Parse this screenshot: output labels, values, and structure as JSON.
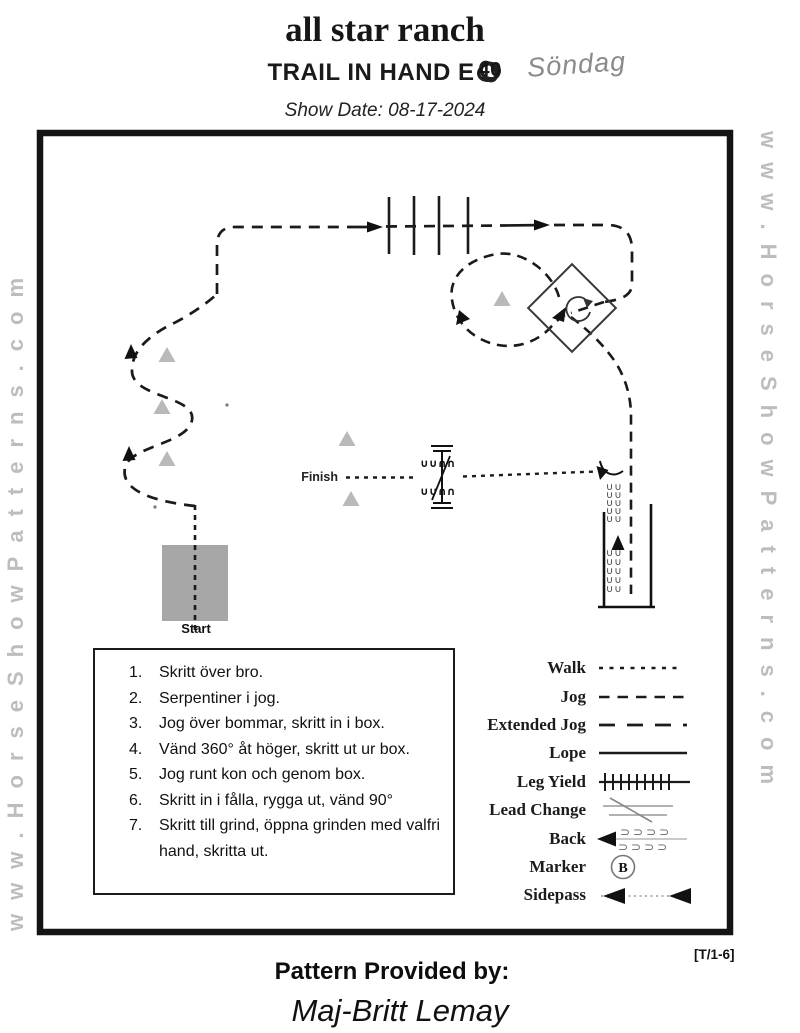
{
  "header": {
    "title": "all star ranch",
    "event_title": "TRAIL IN HAND E",
    "scribbled_number": "40",
    "handwritten_note": "Söndag",
    "show_date": "Show Date: 08-17-2024"
  },
  "watermarks": {
    "left": "www.HorseShowPatterns.com",
    "right": "www.HorseShowPatterns.com"
  },
  "diagram": {
    "start_label": "Start",
    "finish_label": "Finish"
  },
  "instructions": {
    "items": [
      "Skritt över bro.",
      "Serpentiner i jog.",
      "Jog över bommar, skritt in i box.",
      "Vänd 360° åt höger, skritt ut ur box.",
      "Jog runt kon och genom box.",
      "Skritt in i fålla, rygga ut, vänd 90°",
      "Skritt till grind, öppna grinden med valfri hand, skritta ut."
    ]
  },
  "legend": {
    "items": [
      {
        "label": "Walk",
        "symbol": "walk-short-dash-line"
      },
      {
        "label": "Jog",
        "symbol": "jog-dash-line"
      },
      {
        "label": "Extended Jog",
        "symbol": "extended-jog-long-dash-line"
      },
      {
        "label": "Lope",
        "symbol": "lope-solid-line"
      },
      {
        "label": "Leg Yield",
        "symbol": "leg-yield-tick-line"
      },
      {
        "label": "Lead Change",
        "symbol": "lead-change-slash"
      },
      {
        "label": "Back",
        "symbol": "back-arrow-hoofprints"
      },
      {
        "label": "Marker",
        "symbol": "marker-circled-letter",
        "marker_letter": "B"
      },
      {
        "label": "Sidepass",
        "symbol": "sidepass-double-arrow-dotted-line"
      }
    ]
  },
  "footer": {
    "pattern_code": "[T/1-6]",
    "provided_by_label": "Pattern Provided by:",
    "provided_by_name": "Maj-Britt Lemay"
  },
  "colors": {
    "ink": "#1a1a1a",
    "cone_gray": "#b9b9b9",
    "bridge_gray": "#a7a7a7",
    "watermark_gray": "#bdbdbd",
    "handwriting_gray": "#8a8a8a"
  }
}
